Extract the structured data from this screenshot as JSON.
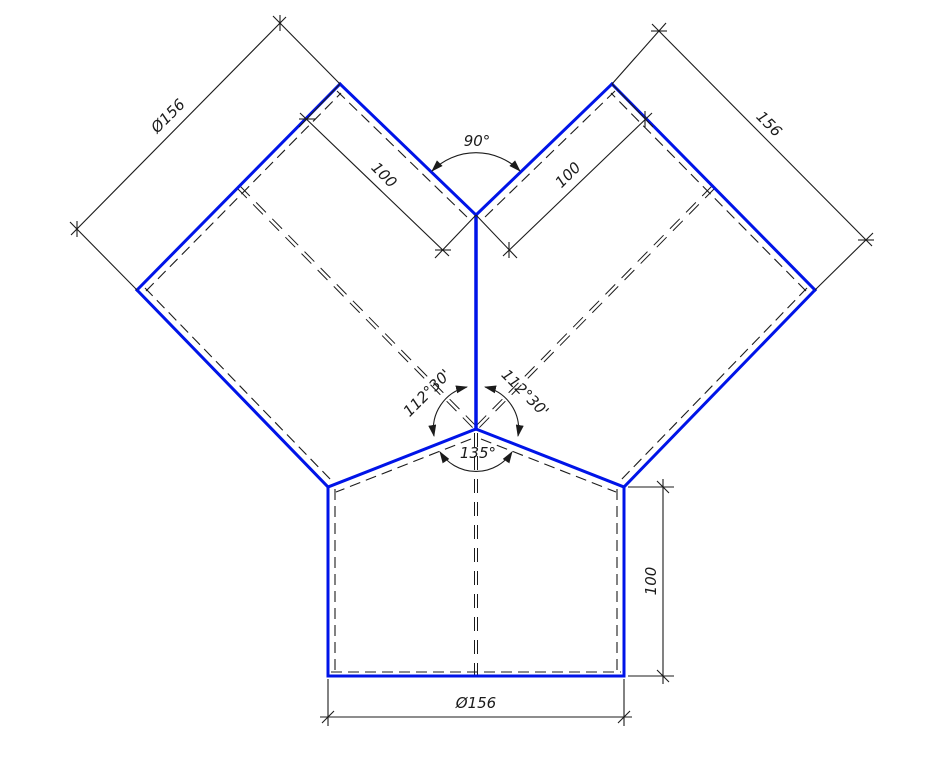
{
  "figure": {
    "description": "Orthographic CAD drawing of a symmetric Y-branch (wye) pipe fitting with two 45-degree inlet branches and a vertical outlet",
    "colors": {
      "outline": "#0014e8",
      "annotation": "#1b1b1b",
      "background": "#ffffff"
    }
  },
  "dimensions": {
    "left_branch_diameter": "Ø156",
    "right_branch_diameter": "156",
    "left_branch_length": "100",
    "right_branch_length": "100",
    "outlet_length": "100",
    "outlet_diameter": "Ø156"
  },
  "angles": {
    "between_branches": "90°",
    "left_branch_to_outlet": "112°30'",
    "right_branch_to_outlet": "112°30'",
    "between_roof_edges": "135°"
  }
}
